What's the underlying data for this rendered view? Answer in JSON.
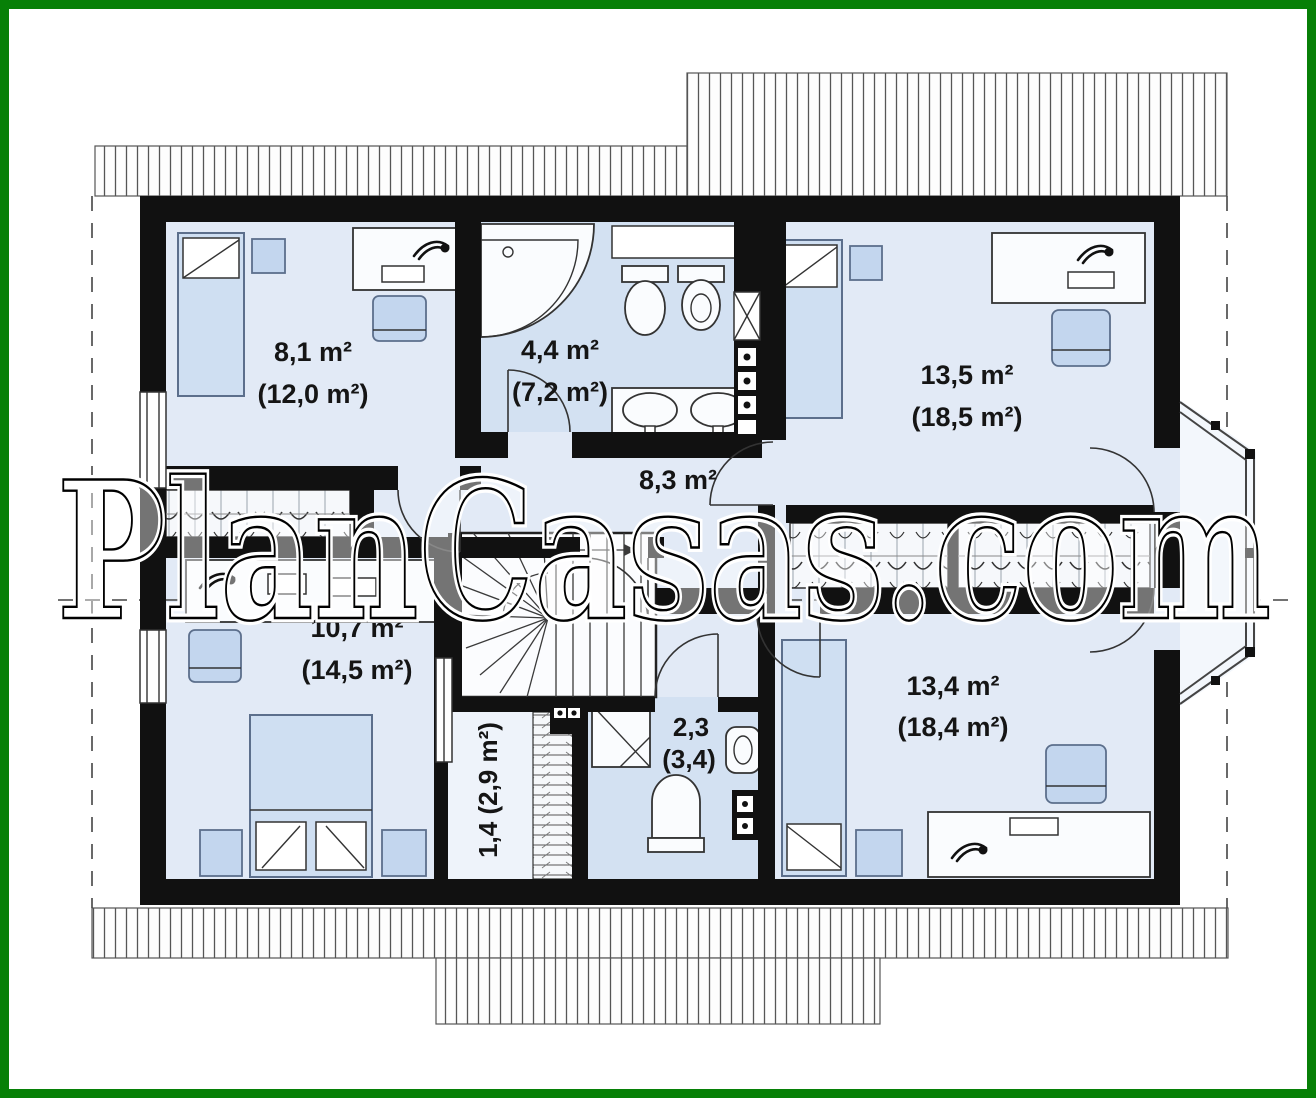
{
  "watermark": {
    "text": "PlanCasas.com"
  },
  "colors": {
    "frame": "#078007",
    "walls": "#111111",
    "room_fill": "#e2eaf6",
    "bath_fill": "#d3e1f2",
    "furniture_blue": "#c3d6ee",
    "watermark_fill": "#ffffff"
  },
  "rooms": {
    "bedroom_top_left": {
      "area": "8,1 m²",
      "area_total": "(12,0 m²)"
    },
    "bathroom": {
      "area": "4,4 m²",
      "area_total": "(7,2 m²)"
    },
    "bedroom_top_right": {
      "area": "13,5 m²",
      "area_total": "(18,5 m²)"
    },
    "hall": {
      "area": "8,3 m²"
    },
    "bedroom_bottom_left": {
      "area": "10,7 m²",
      "area_total": "(14,5 m²)"
    },
    "closet": {
      "label": "1,4 (2,9 m²)"
    },
    "shower_room": {
      "area": "2,3",
      "area_total": "(3,4)"
    },
    "bedroom_bottom_right": {
      "area": "13,4 m²",
      "area_total": "(18,4 m²)"
    }
  }
}
